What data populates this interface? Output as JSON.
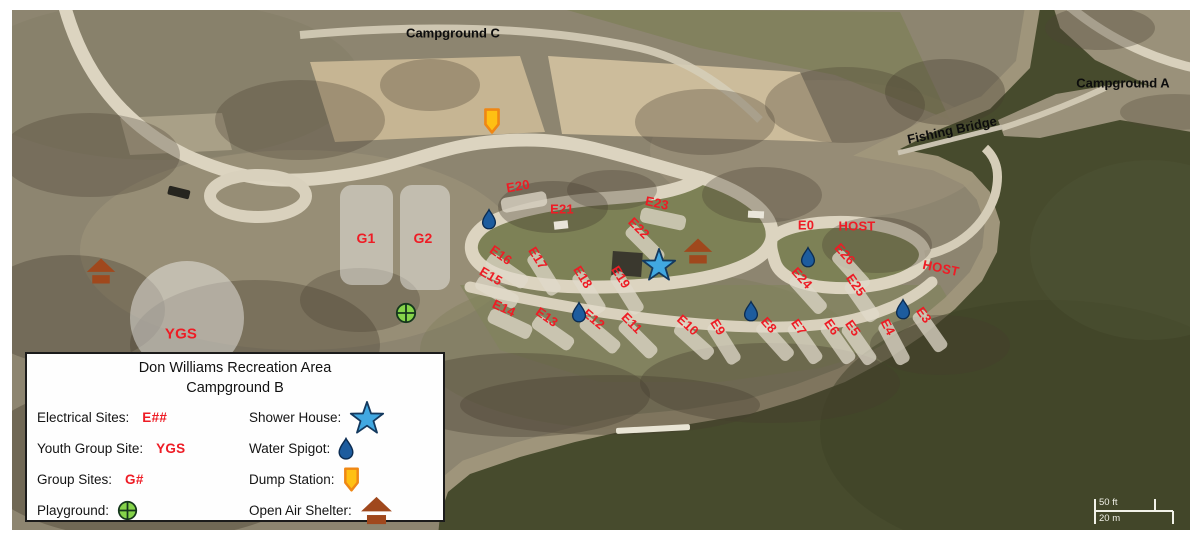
{
  "colors": {
    "site_label": "#ee1c25",
    "area_label": "#0d0d0d",
    "drop_fill": "#1d5c9e",
    "drop_stroke": "#0b2c52",
    "star_fill": "#41a8e1",
    "star_stroke": "#14395e",
    "dump_fill": "#ffc013",
    "dump_stroke": "#ef8714",
    "shelter_fill": "#a0481d",
    "playground_fill": "#85d44a",
    "playground_stroke": "#16381d"
  },
  "map": {
    "area_labels": [
      {
        "text": "Campground C",
        "x": 453,
        "y": 33,
        "rot": 0
      },
      {
        "text": "Campground A",
        "x": 1123,
        "y": 83,
        "rot": 0
      },
      {
        "text": "Fishing Bridge",
        "x": 952,
        "y": 130,
        "rot": -12
      }
    ],
    "sites": [
      {
        "label": "E20",
        "x": 518,
        "y": 186,
        "rot": -10,
        "pad": true
      },
      {
        "label": "E21",
        "x": 562,
        "y": 209,
        "rot": 0,
        "pad": false
      },
      {
        "label": "E23",
        "x": 657,
        "y": 203,
        "rot": 12,
        "pad": true
      },
      {
        "label": "E22",
        "x": 639,
        "y": 228,
        "rot": 45,
        "pad": true
      },
      {
        "label": "E16",
        "x": 501,
        "y": 255,
        "rot": 35,
        "pad": true
      },
      {
        "label": "E17",
        "x": 538,
        "y": 258,
        "rot": 58,
        "pad": true
      },
      {
        "label": "E15",
        "x": 491,
        "y": 276,
        "rot": 30,
        "pad": true
      },
      {
        "label": "E18",
        "x": 583,
        "y": 277,
        "rot": 58,
        "pad": true
      },
      {
        "label": "E19",
        "x": 621,
        "y": 277,
        "rot": 58,
        "pad": true
      },
      {
        "label": "E14",
        "x": 504,
        "y": 308,
        "rot": 25,
        "pad": true
      },
      {
        "label": "E13",
        "x": 547,
        "y": 317,
        "rot": 35,
        "pad": true
      },
      {
        "label": "E12",
        "x": 594,
        "y": 319,
        "rot": 40,
        "pad": true
      },
      {
        "label": "E11",
        "x": 632,
        "y": 323,
        "rot": 45,
        "pad": true
      },
      {
        "label": "E10",
        "x": 688,
        "y": 325,
        "rot": 42,
        "pad": true
      },
      {
        "label": "E9",
        "x": 718,
        "y": 327,
        "rot": 58,
        "pad": true
      },
      {
        "label": "E8",
        "x": 769,
        "y": 325,
        "rot": 48,
        "pad": true
      },
      {
        "label": "E7",
        "x": 799,
        "y": 327,
        "rot": 55,
        "pad": true
      },
      {
        "label": "E6",
        "x": 832,
        "y": 327,
        "rot": 55,
        "pad": true
      },
      {
        "label": "E5",
        "x": 853,
        "y": 328,
        "rot": 55,
        "pad": true
      },
      {
        "label": "E4",
        "x": 888,
        "y": 327,
        "rot": 62,
        "pad": true
      },
      {
        "label": "E3",
        "x": 924,
        "y": 315,
        "rot": 55,
        "pad": true
      },
      {
        "label": "E0",
        "x": 806,
        "y": 225,
        "rot": 0,
        "pad": false
      },
      {
        "label": "HOST",
        "x": 857,
        "y": 226,
        "rot": 0,
        "pad": false
      },
      {
        "label": "E26",
        "x": 845,
        "y": 254,
        "rot": 48,
        "pad": true
      },
      {
        "label": "E24",
        "x": 802,
        "y": 278,
        "rot": 48,
        "pad": true
      },
      {
        "label": "E25",
        "x": 856,
        "y": 285,
        "rot": 55,
        "pad": true
      },
      {
        "label": "HOST",
        "x": 941,
        "y": 268,
        "rot": 12,
        "pad": false
      }
    ],
    "group_sites": [
      {
        "label": "G1",
        "x": 340,
        "y": 185,
        "w": 53,
        "h": 100,
        "label_x": 366,
        "label_y": 238
      },
      {
        "label": "G2",
        "x": 400,
        "y": 185,
        "w": 50,
        "h": 105,
        "label_x": 423,
        "label_y": 238
      }
    ],
    "youth_group_site": {
      "label": "YGS",
      "cx": 187,
      "cy": 318,
      "r": 57,
      "label_x": 181,
      "label_y": 334
    },
    "markers": [
      {
        "type": "dump",
        "x": 492,
        "y": 121
      },
      {
        "type": "drop",
        "x": 489,
        "y": 219
      },
      {
        "type": "drop",
        "x": 579,
        "y": 312
      },
      {
        "type": "drop",
        "x": 751,
        "y": 311
      },
      {
        "type": "drop",
        "x": 808,
        "y": 257
      },
      {
        "type": "drop",
        "x": 903,
        "y": 309
      },
      {
        "type": "star",
        "x": 659,
        "y": 265
      },
      {
        "type": "shelter",
        "x": 101,
        "y": 271
      },
      {
        "type": "shelter",
        "x": 698,
        "y": 251
      },
      {
        "type": "playground",
        "x": 406,
        "y": 313
      }
    ],
    "scale_bar": {
      "ft": "50 ft",
      "m": "20 m"
    }
  },
  "legend": {
    "title_line1": "Don Williams Recreation Area",
    "title_line2": "Campground B",
    "left_rows": [
      {
        "label": "Electrical Sites:",
        "value": "E##"
      },
      {
        "label": "Youth Group Site:",
        "value": "YGS"
      },
      {
        "label": "Group Sites:",
        "value": "G#"
      },
      {
        "label": "Playground:",
        "icon": "playground"
      }
    ],
    "right_rows": [
      {
        "label": "Shower House:",
        "icon": "star"
      },
      {
        "label": "Water Spigot:",
        "icon": "drop"
      },
      {
        "label": "Dump Station:",
        "icon": "dump"
      },
      {
        "label": "Open Air Shelter:",
        "icon": "shelter"
      }
    ]
  }
}
